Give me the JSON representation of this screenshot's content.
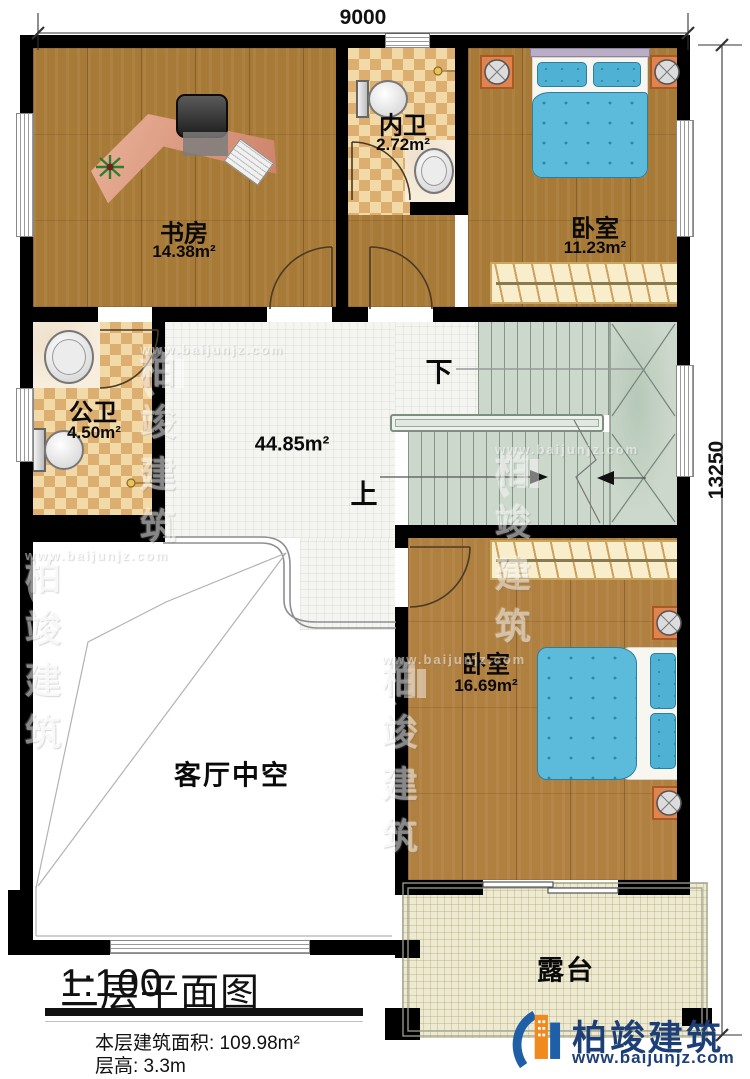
{
  "dimensions": {
    "top": "9000",
    "right": "13250"
  },
  "rooms": {
    "study": {
      "label": "书房",
      "area": "14.38m²"
    },
    "inner_bath": {
      "label": "内卫",
      "area": "2.72m²"
    },
    "bedroom_top": {
      "label": "卧室",
      "area": "11.23m²"
    },
    "public_bath": {
      "label": "公卫",
      "area": "4.50m²"
    },
    "hall": {
      "area": "44.85m²"
    },
    "living_void": {
      "label": "客厅中空"
    },
    "bedroom_bottom": {
      "label": "卧室",
      "area": "16.69m²"
    },
    "terrace": {
      "label": "露台"
    }
  },
  "stairs": {
    "up_label": "上",
    "down_label": "下"
  },
  "footer": {
    "title": "二层平面图",
    "scale": "1:100",
    "floor_area_label": "本层建筑面积: 109.98m²",
    "floor_height_label": "层高: 3.3m"
  },
  "branding": {
    "watermark_brand": "柏竣建筑",
    "watermark_url": "www.baijunjz.com",
    "logo_brand": "柏竣建筑",
    "logo_url": "www.baijunjz.com"
  },
  "colors": {
    "wall": "#000000",
    "wood": "#a87a38",
    "checker": "#dcae6f",
    "bed_blue": "#5cbbdb",
    "stair": "#ccd8cb",
    "terrace": "#edead1",
    "logo_blue": "#1c3f77",
    "logo_orange": "#f18a1e"
  }
}
